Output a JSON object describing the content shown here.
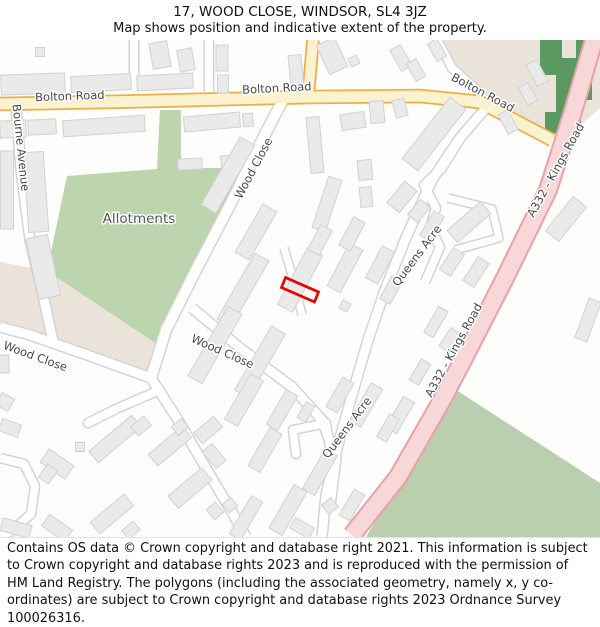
{
  "header": {
    "title": "17, WOOD CLOSE, WINDSOR, SL4 3JZ",
    "subtitle": "Map shows position and indicative extent of the property."
  },
  "footer": {
    "attribution": "Contains OS data © Crown copyright and database right 2021. This information is subject to Crown copyright and database rights 2023 and is reproduced with the permission of HM Land Registry. The polygons (including the associated geometry, namely x, y co-ordinates) are subject to Crown copyright and database rights 2023 Ordnance Survey 100026316."
  },
  "map": {
    "width": 600,
    "height": 497,
    "y_offset": 40,
    "colors": {
      "bg": "#fdfdfc",
      "beige": "#eae3da",
      "green_allotments": "#bdd5ae",
      "green_field": "#b9cfad",
      "green_dark": "#5a9a61",
      "building_fill": "#eaeaea",
      "building_stroke": "#d2d2d2",
      "label": "#494949",
      "allotments_label": "#4e5b4e",
      "halo": "#ffffff",
      "plot_stroke": "#ee0000",
      "minor_fill": "#ffffff",
      "minor_casing": "#d4d4d4",
      "main_fill": "#fbf2d0",
      "main_casing": "#f1ad46",
      "aroad_fill": "#f8d7d8",
      "aroad_casing": "#e9a1a7"
    },
    "areas": [
      {
        "name": "beige-area-north-east",
        "fill": "beige",
        "d": "M437,40 L600,40 L600,108 L560,143 L520,118 L480,92 L452,68 Z"
      },
      {
        "name": "beige-area-west",
        "fill": "beige",
        "d": "M0,262 L47,271 L157,344 L151,380 L60,344 L0,332 Z"
      },
      {
        "name": "allotments-area",
        "fill": "green_allotments",
        "d": "M67,176 L157,169 L160,110 L181,110 L181,168 L247,168 L188,272 L157,344 L47,271 Z"
      },
      {
        "name": "field-area-south-east",
        "fill": "green_field",
        "d": "M453,388 L600,483 L600,537 L366,537 Z"
      },
      {
        "name": "woodland-strip",
        "fill": "green_dark",
        "d": "M540,40 L562,40 L562,58 L576,58 L576,40 L592,40 L592,100 L581,100 L581,133 L545,133 L545,112 L556,112 L556,75 L540,75 Z"
      }
    ],
    "roads": [
      {
        "name": "minor-road-north-1",
        "t": "minor",
        "w": 8,
        "d": "M134,40 L134,90"
      },
      {
        "name": "minor-road-north-2",
        "t": "minor",
        "w": 8,
        "d": "M209,40 L209,92"
      },
      {
        "name": "bourne-avenue",
        "t": "minor",
        "w": 9,
        "d": "M16,108 L21,170 L30,240 L44,300 L53,341"
      },
      {
        "name": "wood-close-upper",
        "t": "minor",
        "w": 10,
        "d": "M286,94 L262,140 L230,205 L196,270 L166,330 L151,378"
      },
      {
        "name": "wood-close-west",
        "t": "minor",
        "w": 9,
        "d": "M151,378 L90,356 L30,335 L0,327"
      },
      {
        "name": "wood-close-south",
        "t": "minor",
        "w": 9,
        "d": "M151,378 L178,420 L207,470 L232,512 L246,537"
      },
      {
        "name": "wood-close-spur",
        "t": "minor",
        "w": 8,
        "cap": "round",
        "d": "M160,390 L118,408 L88,423"
      },
      {
        "name": "wood-close-east",
        "t": "minor",
        "w": 9,
        "d": "M192,308 L240,348 L292,387 L322,420 L336,458 L330,505"
      },
      {
        "name": "queens-acre",
        "t": "minor",
        "w": 9,
        "d": "M491,102 L460,138 L432,180 L405,240 L385,290 L368,340 L352,395 L338,445 L326,495 L322,537"
      },
      {
        "name": "queens-acre-north-loop",
        "t": "minor",
        "w": 8,
        "d": "M490,103 L462,136 L442,168 L424,185 L436,208 L430,228 L440,247 L425,282"
      },
      {
        "name": "queens-acre-east-spur",
        "t": "minor",
        "w": 7,
        "d": "M448,198 L492,209 L499,238 L455,250"
      },
      {
        "name": "estate-loop-road",
        "t": "minor",
        "w": 8,
        "d": "M0,458 L24,464 L35,486 L31,514 L12,531 L0,536"
      },
      {
        "name": "beige-lane",
        "t": "minor",
        "w": 8,
        "d": "M437,40 L452,68 L480,93"
      },
      {
        "name": "horseshoe-close",
        "t": "minor",
        "w": 8,
        "cap": "round",
        "d": "M296,454 L293,430 L326,423 L330,448"
      },
      {
        "name": "plot-access-path",
        "t": "minor",
        "w": 7,
        "d": "M284,248 L294,282 L302,315"
      },
      {
        "name": "bolton-road",
        "t": "main",
        "w": 11,
        "d": "M0,104 L150,101 L310,97 L420,96 L480,102 L552,140"
      },
      {
        "name": "bolton-road-north-branch",
        "t": "main",
        "w": 10,
        "d": "M308,97 L313,40"
      },
      {
        "name": "a332-kings-road",
        "t": "aroad",
        "w": 16,
        "d": "M594,40 L572,115 L548,190 L505,278 L463,360 L442,400 L398,477 L352,535"
      }
    ],
    "buildings": [
      [
        33,
        84,
        64,
        20,
        -2
      ],
      [
        101,
        83,
        60,
        16,
        -3
      ],
      [
        165,
        82,
        56,
        15,
        -3
      ],
      [
        40,
        52,
        9,
        9,
        0
      ],
      [
        160,
        55,
        18,
        26,
        -10
      ],
      [
        186,
        60,
        15,
        22,
        -10
      ],
      [
        222,
        58,
        12,
        26,
        0
      ],
      [
        223,
        84,
        11,
        18,
        0
      ],
      [
        296,
        72,
        13,
        34,
        -5
      ],
      [
        332,
        56,
        20,
        32,
        -25
      ],
      [
        354,
        61,
        9,
        9,
        -25
      ],
      [
        401,
        58,
        12,
        24,
        -30
      ],
      [
        416,
        70,
        11,
        20,
        -30
      ],
      [
        437,
        50,
        11,
        20,
        -30
      ],
      [
        537,
        73,
        12,
        24,
        -28
      ],
      [
        528,
        94,
        11,
        20,
        -28
      ],
      [
        508,
        122,
        11,
        22,
        -28
      ],
      [
        13,
        129,
        26,
        17,
        -3
      ],
      [
        42,
        127,
        28,
        15,
        -3
      ],
      [
        104,
        126,
        82,
        16,
        -4
      ],
      [
        212,
        122,
        56,
        15,
        -5
      ],
      [
        248,
        120,
        10,
        13,
        -5
      ],
      [
        190,
        164,
        24,
        11,
        -3
      ],
      [
        230,
        161,
        18,
        11,
        -3
      ],
      [
        7,
        190,
        13,
        78,
        0
      ],
      [
        36,
        192,
        20,
        80,
        -4
      ],
      [
        43,
        267,
        22,
        62,
        -12
      ],
      [
        353,
        121,
        24,
        16,
        -8
      ],
      [
        377,
        112,
        14,
        22,
        -5
      ],
      [
        400,
        108,
        12,
        18,
        -15
      ],
      [
        315,
        145,
        13,
        56,
        -5
      ],
      [
        365,
        170,
        14,
        20,
        -5
      ],
      [
        366,
        197,
        12,
        20,
        -5
      ],
      [
        327,
        204,
        14,
        54,
        18
      ],
      [
        434,
        134,
        20,
        78,
        38
      ],
      [
        402,
        197,
        16,
        28,
        40
      ],
      [
        419,
        211,
        13,
        20,
        40
      ],
      [
        469,
        222,
        44,
        16,
        -41
      ],
      [
        228,
        175,
        17,
        78,
        30
      ],
      [
        256,
        232,
        16,
        56,
        30
      ],
      [
        243,
        290,
        16,
        76,
        30
      ],
      [
        215,
        345,
        16,
        80,
        30
      ],
      [
        260,
        362,
        16,
        74,
        30
      ],
      [
        300,
        280,
        17,
        64,
        28
      ],
      [
        320,
        240,
        13,
        28,
        28
      ],
      [
        345,
        268,
        15,
        48,
        28
      ],
      [
        352,
        234,
        13,
        32,
        28
      ],
      [
        380,
        265,
        14,
        36,
        28
      ],
      [
        391,
        290,
        12,
        26,
        28
      ],
      [
        345,
        306,
        9,
        9,
        28
      ],
      [
        432,
        226,
        12,
        28,
        30
      ],
      [
        452,
        262,
        13,
        26,
        33
      ],
      [
        476,
        272,
        13,
        28,
        33
      ],
      [
        566,
        219,
        17,
        44,
        39
      ],
      [
        588,
        320,
        13,
        42,
        20
      ],
      [
        436,
        322,
        11,
        30,
        30
      ],
      [
        450,
        340,
        12,
        22,
        33
      ],
      [
        400,
        415,
        13,
        36,
        30
      ],
      [
        420,
        372,
        11,
        24,
        30
      ],
      [
        244,
        400,
        15,
        52,
        30
      ],
      [
        282,
        410,
        13,
        40,
        30
      ],
      [
        306,
        412,
        10,
        18,
        30
      ],
      [
        340,
        395,
        13,
        34,
        30
      ],
      [
        366,
        405,
        13,
        44,
        30
      ],
      [
        388,
        428,
        11,
        26,
        30
      ],
      [
        265,
        450,
        14,
        44,
        30
      ],
      [
        320,
        472,
        14,
        46,
        30
      ],
      [
        288,
        510,
        15,
        50,
        30
      ],
      [
        302,
        528,
        22,
        12,
        30
      ],
      [
        352,
        505,
        12,
        30,
        30
      ],
      [
        330,
        506,
        12,
        12,
        -40
      ],
      [
        246,
        518,
        13,
        44,
        30
      ],
      [
        230,
        505,
        11,
        11,
        -40
      ],
      [
        10,
        428,
        20,
        13,
        20
      ],
      [
        57,
        464,
        30,
        16,
        35
      ],
      [
        48,
        474,
        12,
        16,
        35
      ],
      [
        80,
        447,
        9,
        9,
        0
      ],
      [
        115,
        439,
        56,
        15,
        -40
      ],
      [
        141,
        426,
        17,
        12,
        -40
      ],
      [
        170,
        446,
        44,
        15,
        -40
      ],
      [
        180,
        427,
        13,
        11,
        -40
      ],
      [
        208,
        430,
        26,
        14,
        -40
      ],
      [
        214,
        456,
        13,
        22,
        -40
      ],
      [
        190,
        488,
        44,
        16,
        -40
      ],
      [
        215,
        511,
        12,
        13,
        -40
      ],
      [
        16,
        528,
        30,
        13,
        15
      ],
      [
        57,
        528,
        28,
        14,
        35
      ],
      [
        112,
        514,
        44,
        15,
        -40
      ],
      [
        131,
        530,
        15,
        11,
        -40
      ],
      [
        5,
        402,
        14,
        14,
        30
      ],
      [
        4,
        364,
        10,
        18,
        0
      ]
    ],
    "property_plot": {
      "name": "property-boundary-17-wood-close",
      "points": "285.5,277.5 318.5,292 314.5,302 281.5,287.5",
      "stroke_width": 2.7
    },
    "labels": [
      {
        "t": "Bolton Road",
        "x": 70,
        "y": 100,
        "r": -2
      },
      {
        "t": "Bolton Road",
        "x": 277,
        "y": 92,
        "r": -3
      },
      {
        "t": "Bolton Road",
        "x": 481,
        "y": 96,
        "r": 28
      },
      {
        "t": "Bourne Avenue",
        "x": 17,
        "y": 148,
        "r": 84
      },
      {
        "t": "Wood Close",
        "x": 257,
        "y": 170,
        "r": -62
      },
      {
        "t": "Allotments",
        "x": 139,
        "y": 223,
        "r": 0,
        "s": 13.5,
        "c": "allotments_label"
      },
      {
        "t": "Wood Close",
        "x": 34,
        "y": 360,
        "r": 20
      },
      {
        "t": "Wood Close",
        "x": 221,
        "y": 355,
        "r": 24
      },
      {
        "t": "Queens Acre",
        "x": 420,
        "y": 258,
        "r": -53
      },
      {
        "t": "Queens Acre",
        "x": 350,
        "y": 430,
        "r": -53
      },
      {
        "t": "A332 - Kings Road",
        "x": 559,
        "y": 172,
        "r": -61
      },
      {
        "t": "A332 - Kings Road",
        "x": 457,
        "y": 352,
        "r": -61
      }
    ],
    "label_default_size": 11.5
  }
}
